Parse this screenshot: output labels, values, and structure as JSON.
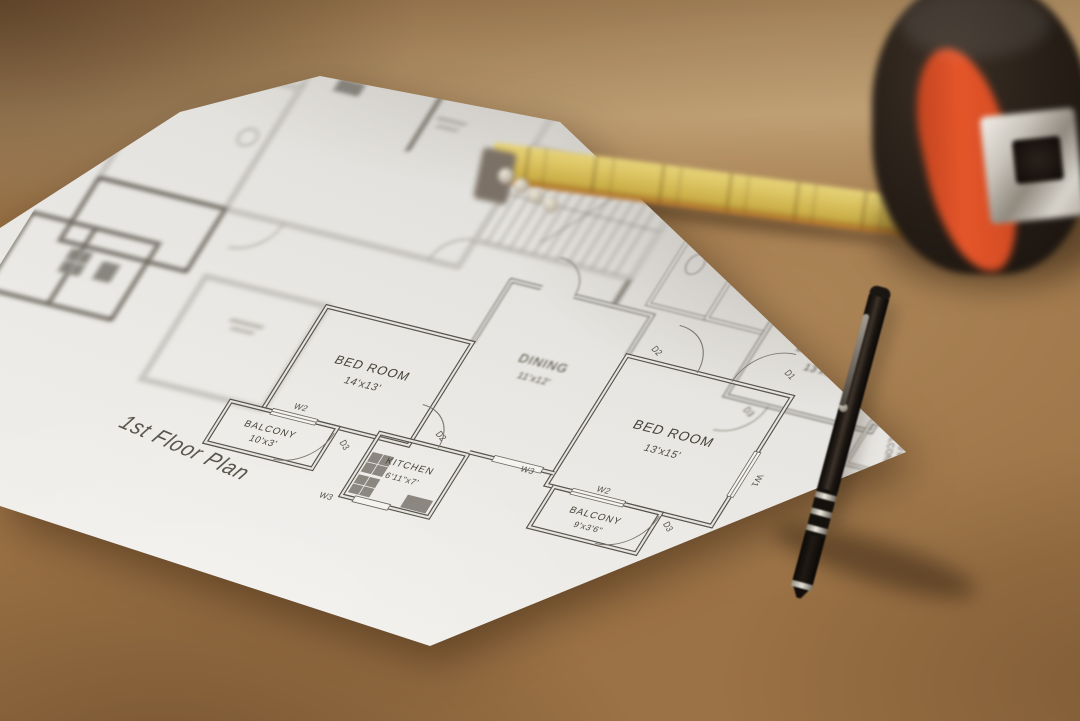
{
  "floor_plan": {
    "title": "1st Floor Plan",
    "rooms": [
      {
        "name": "BED ROOM",
        "size": "14'x13'"
      },
      {
        "name": "BALCONY",
        "size": "10'x3'"
      },
      {
        "name": "KITCHEN",
        "size": "6'11\"x7'"
      },
      {
        "name": "DINING",
        "size": "11'x12'"
      },
      {
        "name": "BED ROOM",
        "size": "13'x15'"
      },
      {
        "name": "BALCONY",
        "size": "9'x3'6\""
      },
      {
        "name": "BED ROOM",
        "size": "13'x9'6\""
      },
      {
        "name": "BALCONY",
        "size": "10'x3'6\""
      }
    ],
    "markers": [
      {
        "label": "W2"
      },
      {
        "label": "D3"
      },
      {
        "label": "W3"
      },
      {
        "label": "D2"
      },
      {
        "label": "D2"
      },
      {
        "label": "D1"
      },
      {
        "label": "W1"
      },
      {
        "label": "W2"
      },
      {
        "label": "D3"
      },
      {
        "label": "W3"
      },
      {
        "label": "D3"
      }
    ]
  },
  "objects": {
    "tape_measure": {
      "label": "tape-measure",
      "body_color": "#1d1713",
      "accent_color": "#d94f28",
      "blade_color": "#d6bc55"
    },
    "pen": {
      "label": "ballpoint-pen",
      "body_color": "#17120e",
      "ring_color": "#cfcabf"
    },
    "table": {
      "label": "wooden-table",
      "wood_color": "#a0703d"
    },
    "paper": {
      "label": "floor-plan-sheet",
      "paper_color": "#e8e6e2",
      "ink_color": "#57534c"
    }
  }
}
